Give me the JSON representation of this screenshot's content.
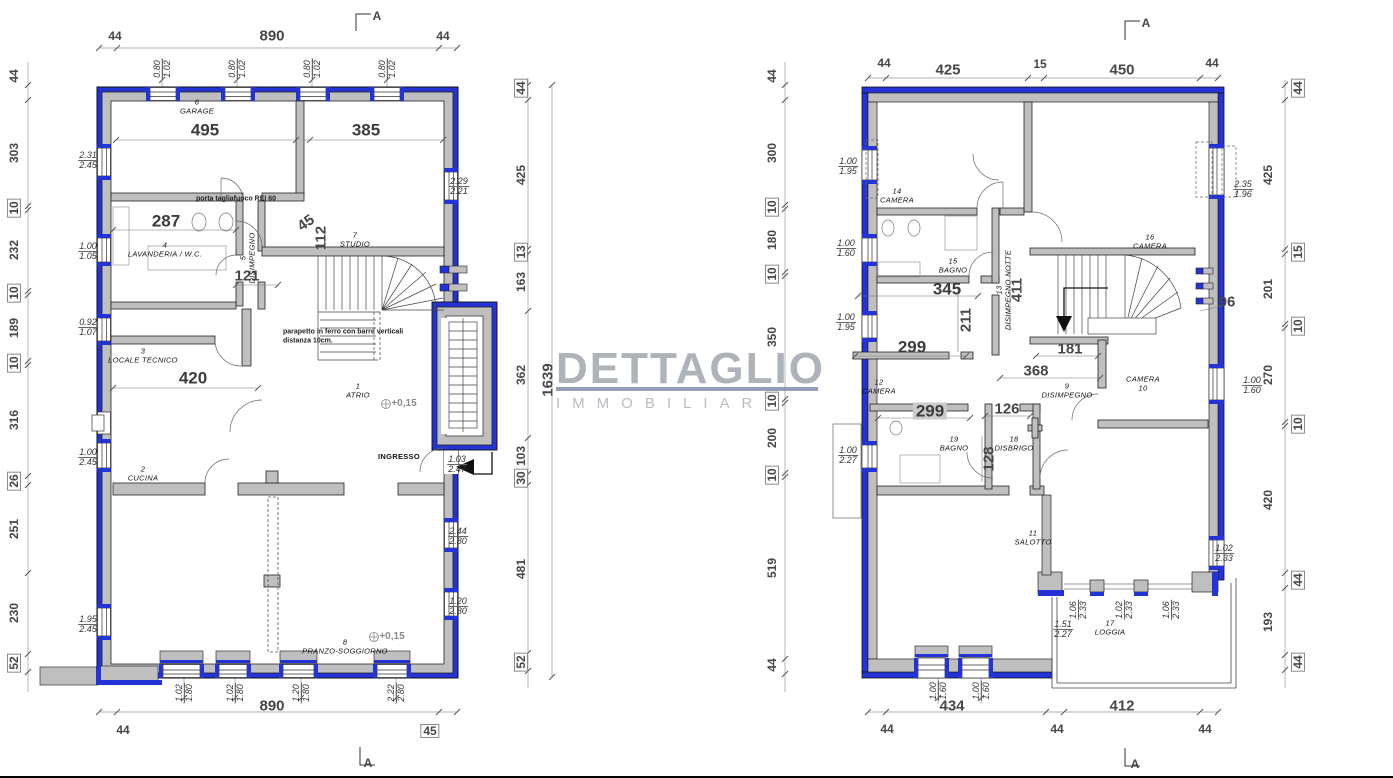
{
  "watermark": {
    "line1": "DETTAGLIO",
    "line2": "IMMOBILIARE"
  },
  "p1": {
    "marker": "A",
    "top": [
      "44",
      "890",
      "44"
    ],
    "top_win": [
      {
        "a": "0.80",
        "b": "1.02"
      },
      {
        "a": "0.80",
        "b": "1.02"
      },
      {
        "a": "0.80",
        "b": "1.02"
      },
      {
        "a": "0.80",
        "b": "1.02"
      }
    ],
    "left": [
      "44",
      "303",
      "10",
      "232",
      "10",
      "189",
      "10",
      "316",
      "26",
      "251",
      "230",
      "52"
    ],
    "right": [
      "44",
      "425",
      "13",
      "163",
      "362",
      "103",
      "30",
      "481",
      "52"
    ],
    "total": "1639",
    "bottom": [
      "890",
      "44",
      "45"
    ],
    "bottom_win": [
      {
        "a": "1.02",
        "b": "1.80"
      },
      {
        "a": "1.02",
        "b": "1.80"
      },
      {
        "a": "1.20",
        "b": "1.80"
      },
      {
        "a": "2.22",
        "b": "2.80"
      }
    ],
    "inner": {
      "garage": "495",
      "garage2": "385",
      "lavanderia": "287",
      "corridoio": "121",
      "d45": "45",
      "d112": "112",
      "tecnico": "420"
    },
    "open": [
      {
        "a": "2.31",
        "b": "2.45"
      },
      {
        "a": "2.29",
        "b": "2.21"
      },
      {
        "a": "1.00",
        "b": "1.05"
      },
      {
        "a": "0.92",
        "b": "1.07"
      },
      {
        "a": "1.00",
        "b": "2.45"
      },
      {
        "a": "1.03",
        "b": "2.47"
      },
      {
        "a": "2.44",
        "b": "2.80"
      },
      {
        "a": "1.20",
        "b": "2.80"
      },
      {
        "a": "1.95",
        "b": "2.45"
      }
    ],
    "rooms": [
      {
        "n": "6",
        "t": "GARAGE"
      },
      {
        "n": "4",
        "t": "LAVANDERIA / W.C."
      },
      {
        "n": "5",
        "t": "DISIMPEGNO"
      },
      {
        "n": "7",
        "t": "STUDIO"
      },
      {
        "n": "3",
        "t": "LOCALE TECNICO"
      },
      {
        "n": "1",
        "t": "ATRIO"
      },
      {
        "n": "2",
        "t": "CUCINA"
      },
      {
        "n": "8",
        "t": "PRANZO-SOGGIORNO"
      }
    ],
    "ingresso": "INGRESSO",
    "note_door": "porta tagliafuoco REI 60",
    "note_par1": "parapetto in ferro con barre verticali",
    "note_par2": "distanza 10cm.",
    "level": "+0,15"
  },
  "p2": {
    "marker": "A",
    "top": [
      "44",
      "425",
      "15",
      "450",
      "44"
    ],
    "left": [
      "44",
      "300",
      "10",
      "180",
      "10",
      "350",
      "10",
      "200",
      "10",
      "519",
      "44"
    ],
    "right": [
      "44",
      "425",
      "15",
      "201",
      "10",
      "270",
      "10",
      "420",
      "44",
      "193",
      "44"
    ],
    "bottom": [
      "434",
      "412",
      "44",
      "44",
      "44"
    ],
    "bottom_win": [
      {
        "a": "1.00",
        "b": "1.60"
      },
      {
        "a": "1.00",
        "b": "1.60"
      }
    ],
    "inner": {
      "bagno": "345",
      "camera12": "299",
      "d211": "211",
      "notte": "411",
      "stair": "181",
      "apertura": "368",
      "camera12b": "299",
      "d126": "126",
      "disbrigo": "128",
      "d96": "96"
    },
    "open": [
      {
        "a": "1.00",
        "b": "1.95"
      },
      {
        "a": "2.35",
        "b": "1.96"
      },
      {
        "a": "1.00",
        "b": "1.60"
      },
      {
        "a": "1.00",
        "b": "1.95"
      },
      {
        "a": "1.00",
        "b": "2.27"
      },
      {
        "a": "1.00",
        "b": "1.60"
      },
      {
        "a": "1.02",
        "b": "2.33"
      },
      {
        "a": "1.06",
        "b": "2.33"
      },
      {
        "a": "1.02",
        "b": "2.33"
      },
      {
        "a": "1.06",
        "b": "2.33"
      },
      {
        "a": "1.51",
        "b": "2.27"
      }
    ],
    "rooms": [
      {
        "n": "14",
        "t": "CAMERA"
      },
      {
        "n": "15",
        "t": "BAGNO"
      },
      {
        "n": "16",
        "t": "CAMERA"
      },
      {
        "n": "13",
        "t": "DISIMPEGNO NOTTE"
      },
      {
        "n": "12",
        "t": "CAMERA"
      },
      {
        "n": "9",
        "t": "DISIMPEGNO"
      },
      {
        "n": "10",
        "t": "CAMERA"
      },
      {
        "n": "19",
        "t": "BAGNO"
      },
      {
        "n": "18",
        "t": "DISBRIGO"
      },
      {
        "n": "11",
        "t": "SALOTTO"
      },
      {
        "n": "17",
        "t": "LOGGIA"
      }
    ]
  }
}
